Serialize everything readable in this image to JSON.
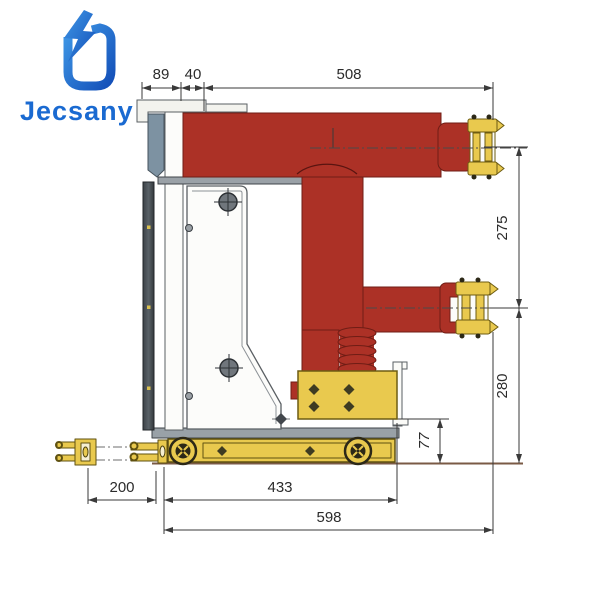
{
  "brand": {
    "name": "Jecsany"
  },
  "drawing": {
    "dims": {
      "d89": "89",
      "d40": "40",
      "d508": "508",
      "d275": "275",
      "d280": "280",
      "d77": "77",
      "d200": "200",
      "d433": "433",
      "d598": "598"
    }
  },
  "colors": {
    "brand_blue": "#1a6ad1",
    "body_red": "#ac3126",
    "hardware_yellow": "#e9c94e",
    "steel_blue_gray": "#7d92a2",
    "dark_plate": "#4b5258",
    "dimension_line": "#3a3a3a"
  }
}
